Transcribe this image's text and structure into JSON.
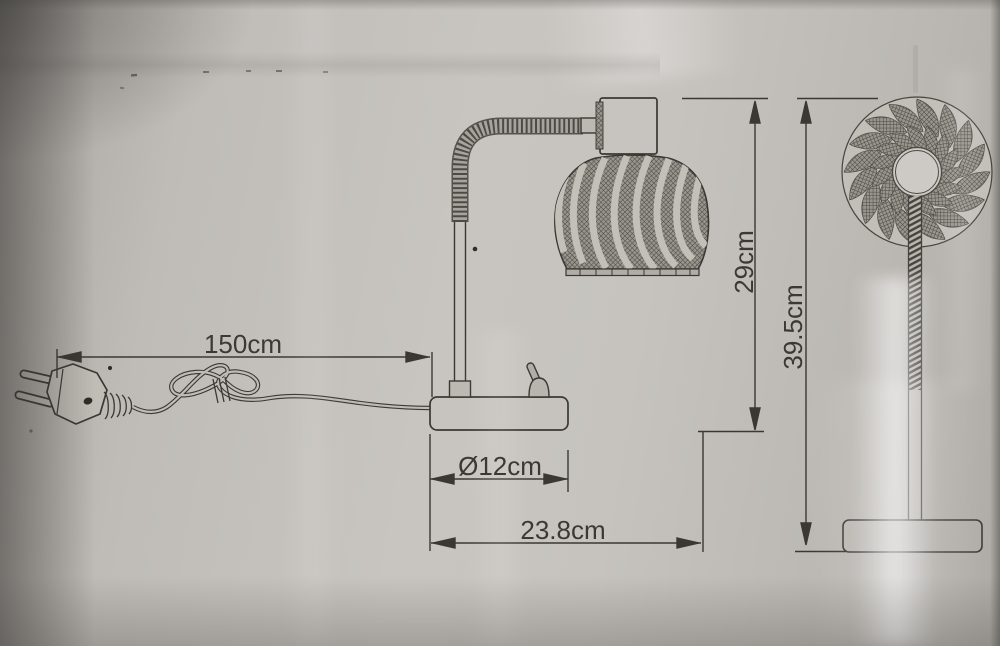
{
  "diagram": {
    "labels": {
      "cord_length": "150cm",
      "base_diameter": "Ø12cm",
      "base_depth": "23.8cm",
      "lamp_height": "29cm",
      "total_height": "39.5cm"
    },
    "colors": {
      "line": "#3a3833",
      "background": "#c1beb9",
      "text": "#3b3935"
    }
  }
}
